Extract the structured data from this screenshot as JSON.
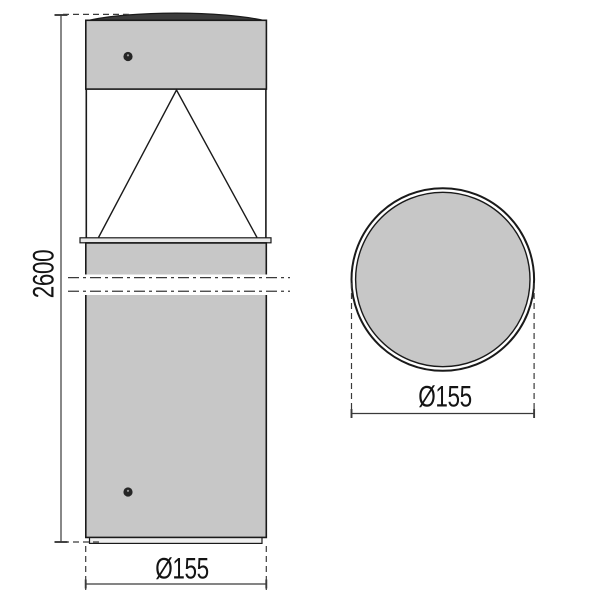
{
  "drawing": {
    "title": "Bollard luminaire dimension drawing",
    "views": {
      "front": {
        "name": "front elevation"
      },
      "top": {
        "name": "top view"
      }
    },
    "dimensions": {
      "height": {
        "label": "2600"
      },
      "diameter_front": {
        "label": "Ø155"
      },
      "diameter_top": {
        "label": "Ø155"
      }
    },
    "colors": {
      "background": "#ffffff",
      "body_fill": "#c7c7c7",
      "rim_fill": "#e8e8e8",
      "base_fill": "#efefef",
      "dome_fill": "#3c3c3c",
      "screw_fill": "#262626",
      "outline": "#1a1a1a",
      "dimension": "#3a3a3a",
      "text": "#141414"
    }
  }
}
